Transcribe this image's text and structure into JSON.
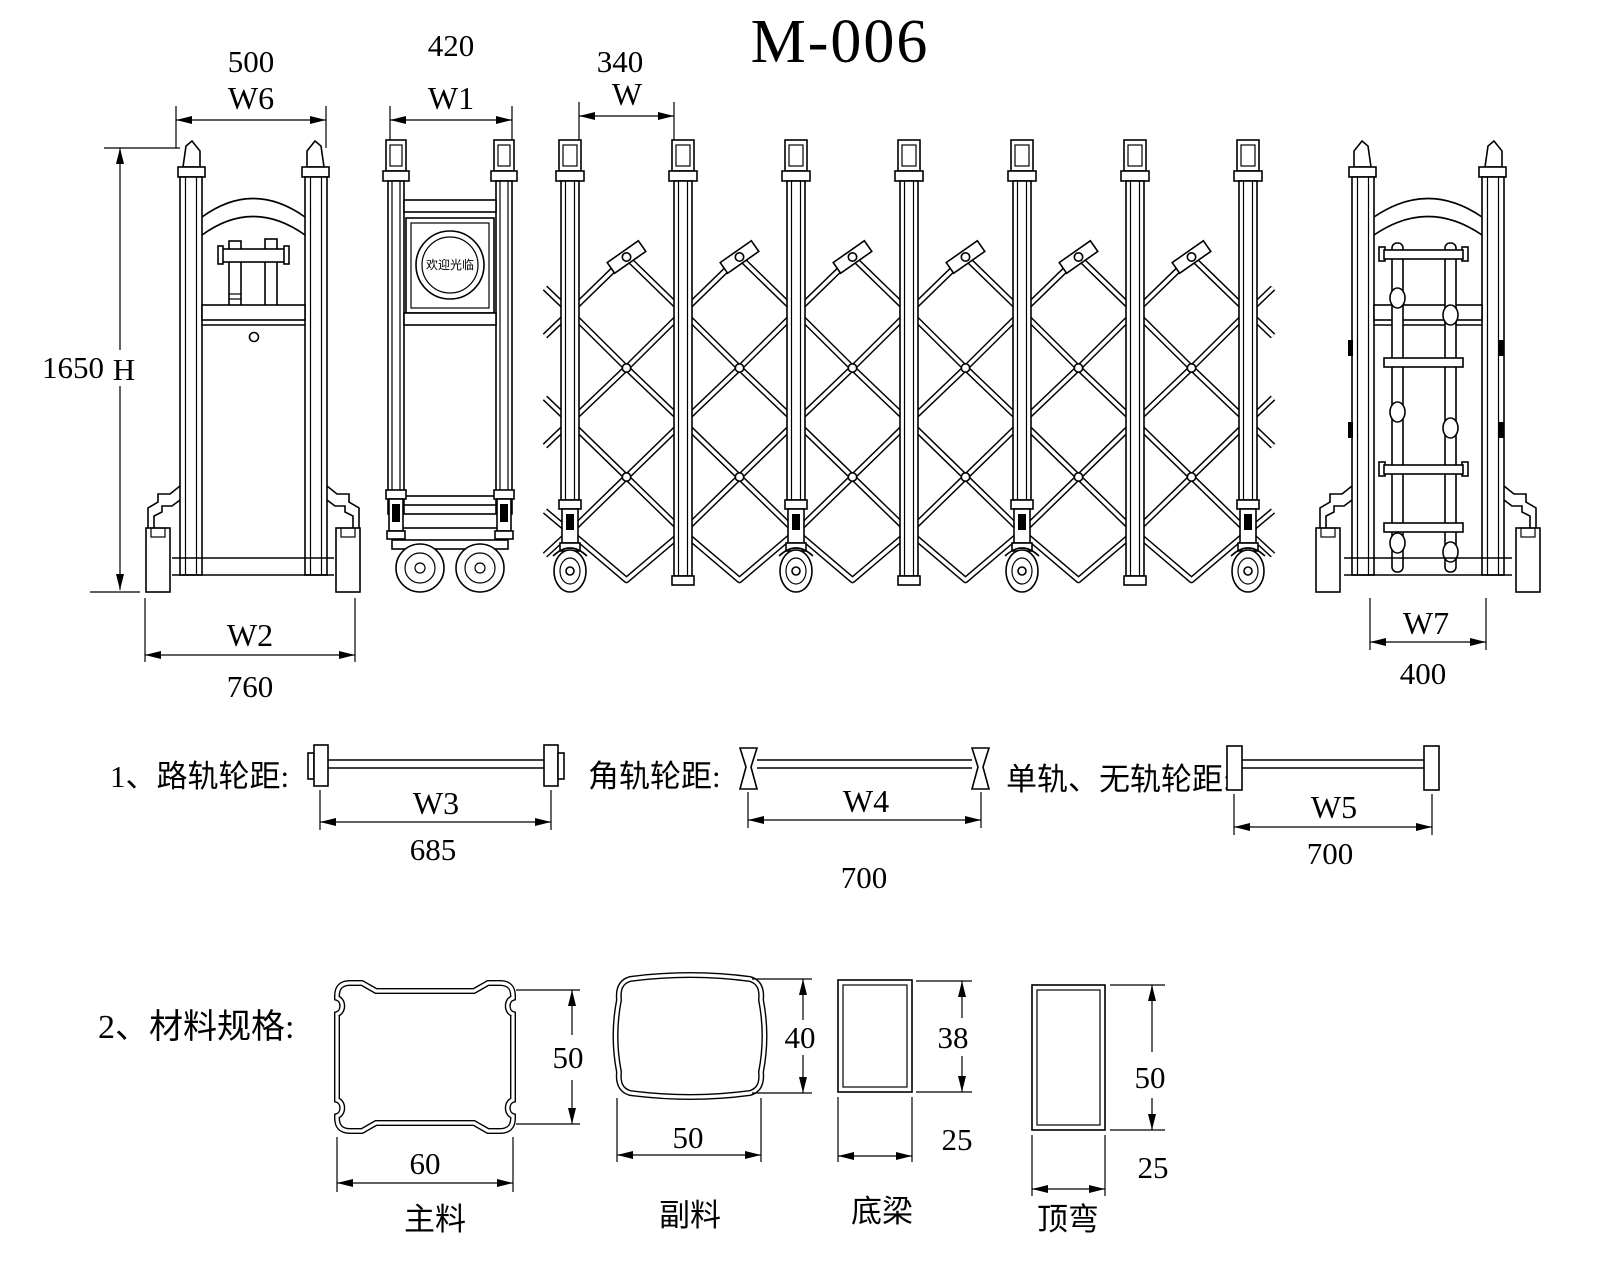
{
  "title": "M-006",
  "drawing": {
    "left_view": {
      "width_value": "500",
      "width_label": "W6",
      "height_value": "1650",
      "height_label": "H",
      "base_label": "W2",
      "base_value": "760"
    },
    "front_view": {
      "width_value": "420",
      "width_label": "W1",
      "sign_text": "欢迎光临"
    },
    "gate_section": {
      "pitch_value": "340",
      "pitch_label": "W"
    },
    "right_view": {
      "base_label": "W7",
      "base_value": "400"
    }
  },
  "track_specs": {
    "items": [
      {
        "label": "1、路轨轮距:",
        "dim_label": "W3",
        "dim_value": "685"
      },
      {
        "label": "角轨轮距:",
        "dim_label": "W4",
        "dim_value": "700"
      },
      {
        "label": "单轨、无轨轮距:",
        "dim_label": "W5",
        "dim_value": "700"
      }
    ]
  },
  "material_specs": {
    "heading": "2、材料规格:",
    "items": [
      {
        "name": "主料",
        "width": "60",
        "height": "50"
      },
      {
        "name": "副料",
        "width": "50",
        "height": "40"
      },
      {
        "name": "底梁",
        "width": "25",
        "height": "38"
      },
      {
        "name": "顶弯",
        "width": "25",
        "height": "50"
      }
    ]
  },
  "colors": {
    "line": "#000000",
    "background": "#ffffff"
  }
}
